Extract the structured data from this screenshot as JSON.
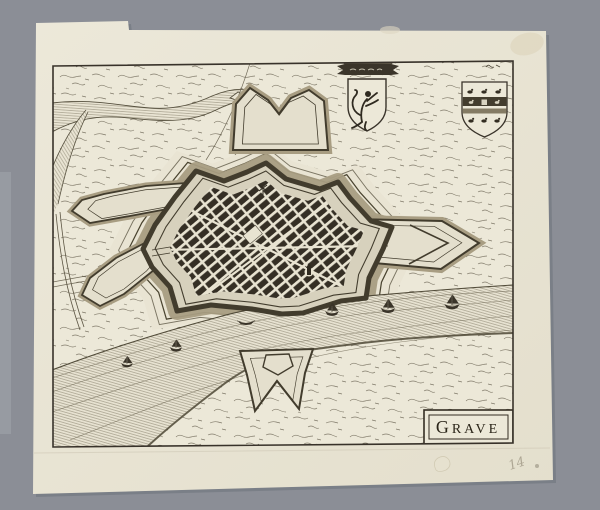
{
  "scene": {
    "type": "antique-engraved-town-plan",
    "background_color": "#8b8e96",
    "paper_color": "#ebe7d8",
    "ink_color": "#39332a",
    "water_color": "#e7e2d1",
    "moat_color": "#a89d82"
  },
  "cartouche": {
    "title": "Grave",
    "title_initial": "G",
    "title_rest": "RAVE"
  },
  "annotations": {
    "pencil_number": "14"
  },
  "heraldry": {
    "left_shield": "rampant-lion-shield-with-banner",
    "right_shield": "shield-with-three-rows-of-merlettes"
  },
  "features": [
    "star-fortress-with-bastions",
    "walled-town-street-grid",
    "moat",
    "river-with-sailboats",
    "tributary-stream",
    "hornworks-and-outworks",
    "rowboat"
  ]
}
